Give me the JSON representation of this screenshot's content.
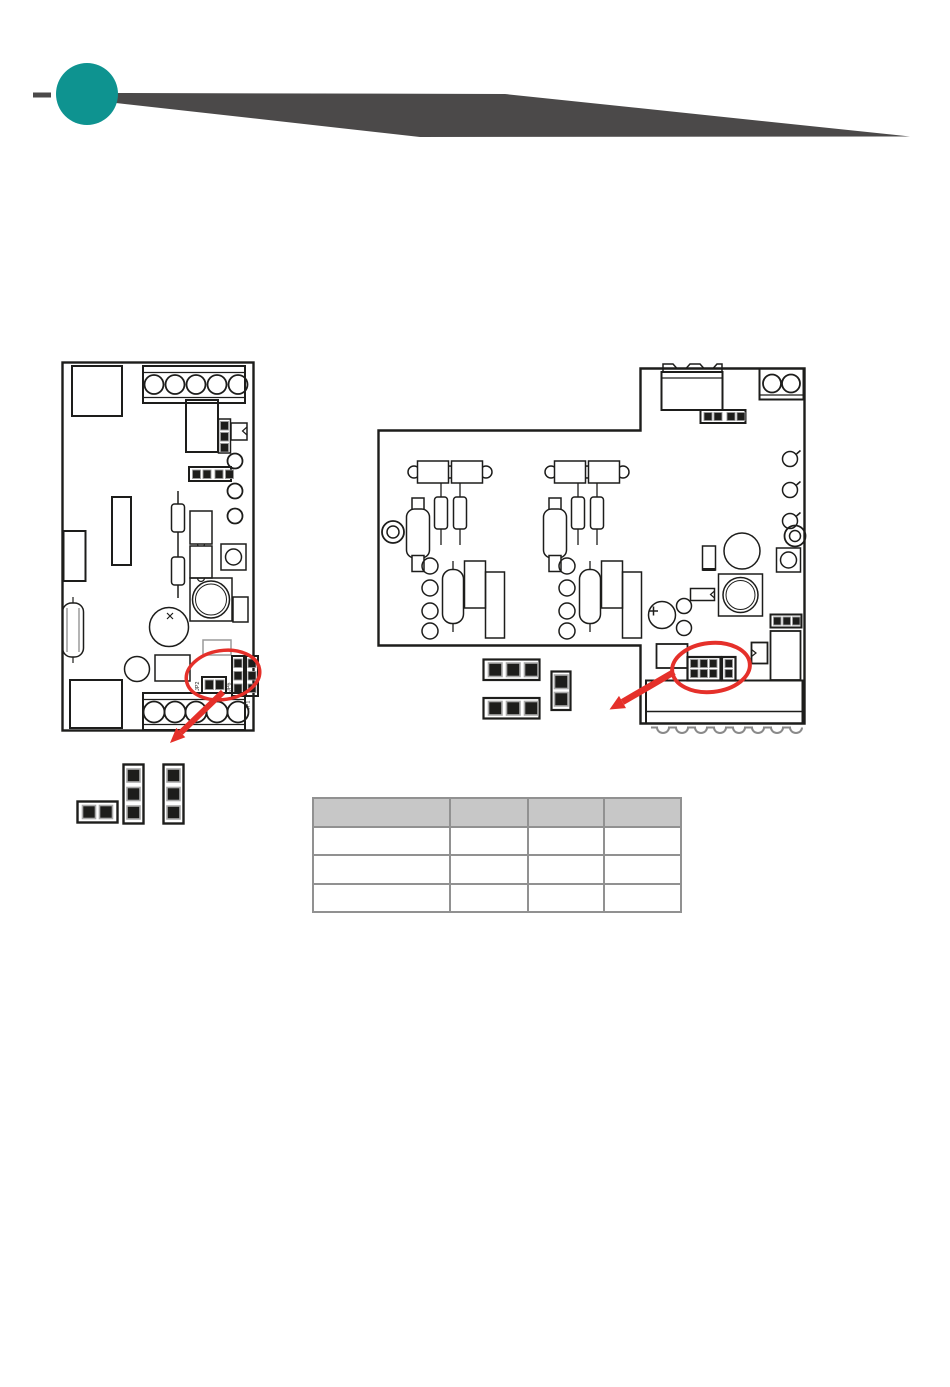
{
  "page": {
    "background": "#ffffff"
  },
  "header": {
    "accent_circle_color": "#0e9390",
    "banner_color": "#4b4949",
    "dash_color": "#4b4949"
  },
  "highlight": {
    "color": "#e5302a"
  },
  "left_board": {
    "jumper_labels": {
      "jp2": "JP2",
      "jp6": "JP6",
      "jp1": "JP1"
    }
  },
  "table": {
    "header_fill": "#c7c7c7",
    "border_color": "#919191",
    "columns": [
      "",
      "",
      "",
      ""
    ],
    "rows": [
      [
        "",
        "",
        "",
        ""
      ],
      [
        "",
        "",
        "",
        ""
      ],
      [
        "",
        "",
        "",
        ""
      ]
    ]
  }
}
